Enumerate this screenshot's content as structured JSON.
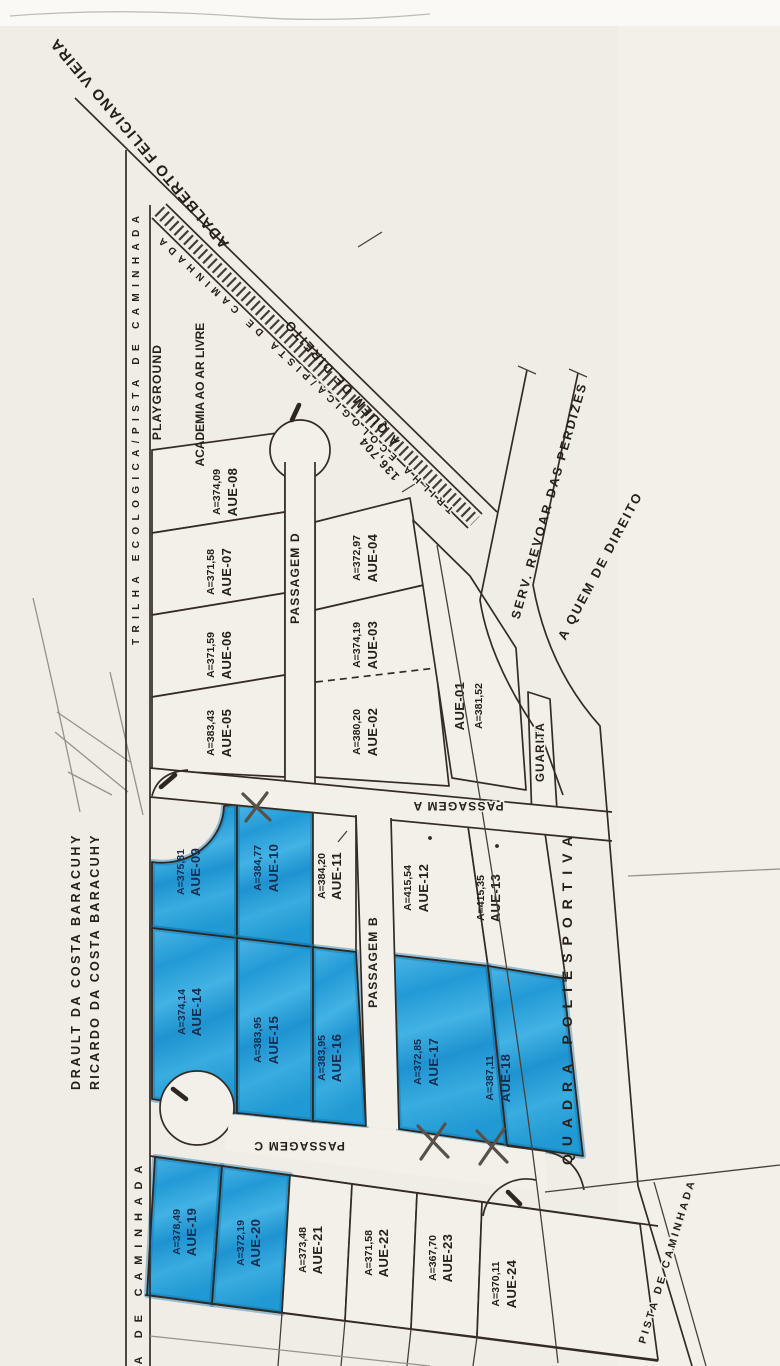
{
  "map": {
    "labels": {
      "street_top": "ADALBERTO FELICIANO VIEIRA",
      "trilha_diagonal": "TRILHA ECOLOGICA/PISTA DE CAMINHADA",
      "trilha_left": "TRILHA ECOLOGICA/PISTA DE CAMINHADA",
      "measure": "136,704",
      "a_quem_top": "A QUEM DE DIREITO",
      "a_quem_right": "A QUEM DE DIREITO",
      "serv": "SERV. REVOAR DAS PERDIZES",
      "playground": "PLAYGROUND",
      "academia": "ACADEMIA AO AR LIVRE",
      "passagem_a": "PASSAGEM A",
      "passagem_b": "PASSAGEM B",
      "passagem_c": "PASSAGEM C",
      "passagem_d": "PASSAGEM D",
      "guarita": "GUARITA",
      "quadra": "QUADRA POLIESPORTIVA",
      "owner_1": "DRAULT DA COSTA BARACUHY",
      "owner_2": "RICARDO DA COSTA BARACUHY",
      "pista_left": "PISTA DE CAMINHADA",
      "pista_right": "PISTA DE CAMINHADA"
    },
    "lots": [
      {
        "id": "AUE-01",
        "area": "A=381,52",
        "highlighted": false
      },
      {
        "id": "AUE-02",
        "area": "A=380,20",
        "highlighted": false
      },
      {
        "id": "AUE-03",
        "area": "A=374,19",
        "highlighted": false
      },
      {
        "id": "AUE-04",
        "area": "A=372,97",
        "highlighted": false
      },
      {
        "id": "AUE-05",
        "area": "A=383,43",
        "highlighted": false
      },
      {
        "id": "AUE-06",
        "area": "A=371,59",
        "highlighted": false
      },
      {
        "id": "AUE-07",
        "area": "A=371,58",
        "highlighted": false
      },
      {
        "id": "AUE-08",
        "area": "A=374,09",
        "highlighted": false
      },
      {
        "id": "AUE-09",
        "area": "A=375,81",
        "highlighted": true
      },
      {
        "id": "AUE-10",
        "area": "A=384,77",
        "highlighted": true
      },
      {
        "id": "AUE-11",
        "area": "A=384,20",
        "highlighted": false
      },
      {
        "id": "AUE-12",
        "area": "A=415,54",
        "highlighted": false
      },
      {
        "id": "AUE-13",
        "area": "A=415,35",
        "highlighted": false
      },
      {
        "id": "AUE-14",
        "area": "A=374,14",
        "highlighted": true
      },
      {
        "id": "AUE-15",
        "area": "A=383,95",
        "highlighted": true
      },
      {
        "id": "AUE-16",
        "area": "A=383,95",
        "highlighted": true
      },
      {
        "id": "AUE-17",
        "area": "A=372,85",
        "highlighted": true
      },
      {
        "id": "AUE-18",
        "area": "A=387,11",
        "highlighted": true
      },
      {
        "id": "AUE-19",
        "area": "A=378,49",
        "highlighted": true
      },
      {
        "id": "AUE-20",
        "area": "A=372,19",
        "highlighted": true
      },
      {
        "id": "AUE-21",
        "area": "A=373,48",
        "highlighted": false
      },
      {
        "id": "AUE-22",
        "area": "A=371,58",
        "highlighted": false
      },
      {
        "id": "AUE-23",
        "area": "A=367,70",
        "highlighted": false
      },
      {
        "id": "AUE-24",
        "area": "A=370,11",
        "highlighted": false
      }
    ],
    "colors": {
      "highlight": "#2ba3db",
      "paper": "#f1eee7",
      "ink": "#2e2720"
    }
  }
}
